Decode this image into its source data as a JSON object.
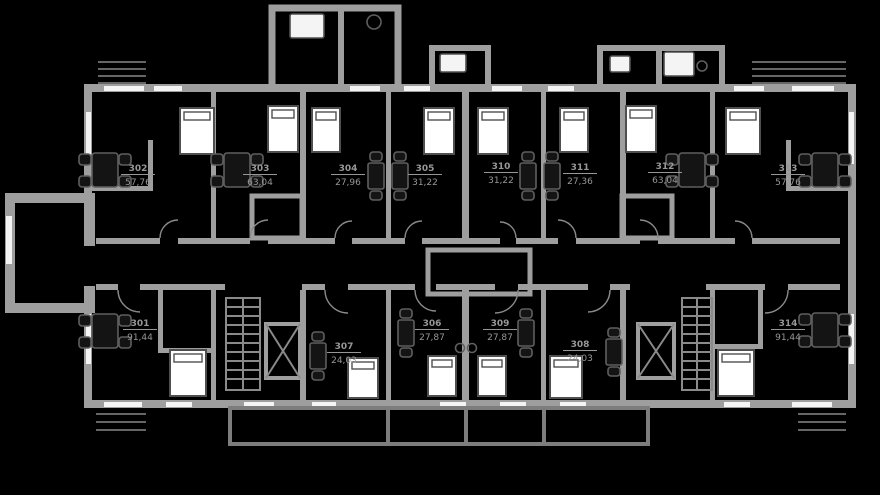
{
  "plan_title": "residential-floor-plan",
  "colors": {
    "background": "#000000",
    "wall": "#9e9e9e",
    "wall_soft": "#8a8a8a",
    "window": "#f4f4f4",
    "bed_fill": "#ffffff",
    "bed_stroke": "#4f4f4f",
    "furn_fill": "#141414",
    "furn_stroke": "#5f5f5f",
    "label_text": "#979797",
    "balcony": "#7d7d7d",
    "hatch": "#666666"
  },
  "units": [
    {
      "number": "302",
      "area": "57,76"
    },
    {
      "number": "303",
      "area": "63,04"
    },
    {
      "number": "304",
      "area": "27,96"
    },
    {
      "number": "305",
      "area": "31,22"
    },
    {
      "number": "310",
      "area": "31,22"
    },
    {
      "number": "311",
      "area": "27,36"
    },
    {
      "number": "312",
      "area": "63,04"
    },
    {
      "number": "313",
      "area": "57,76"
    },
    {
      "number": "301",
      "area": "91,44"
    },
    {
      "number": "307",
      "area": "24,03"
    },
    {
      "number": "306",
      "area": "27,87"
    },
    {
      "number": "309",
      "area": "27,87"
    },
    {
      "number": "308",
      "area": "24,03"
    },
    {
      "number": "314",
      "area": "91,44"
    }
  ]
}
